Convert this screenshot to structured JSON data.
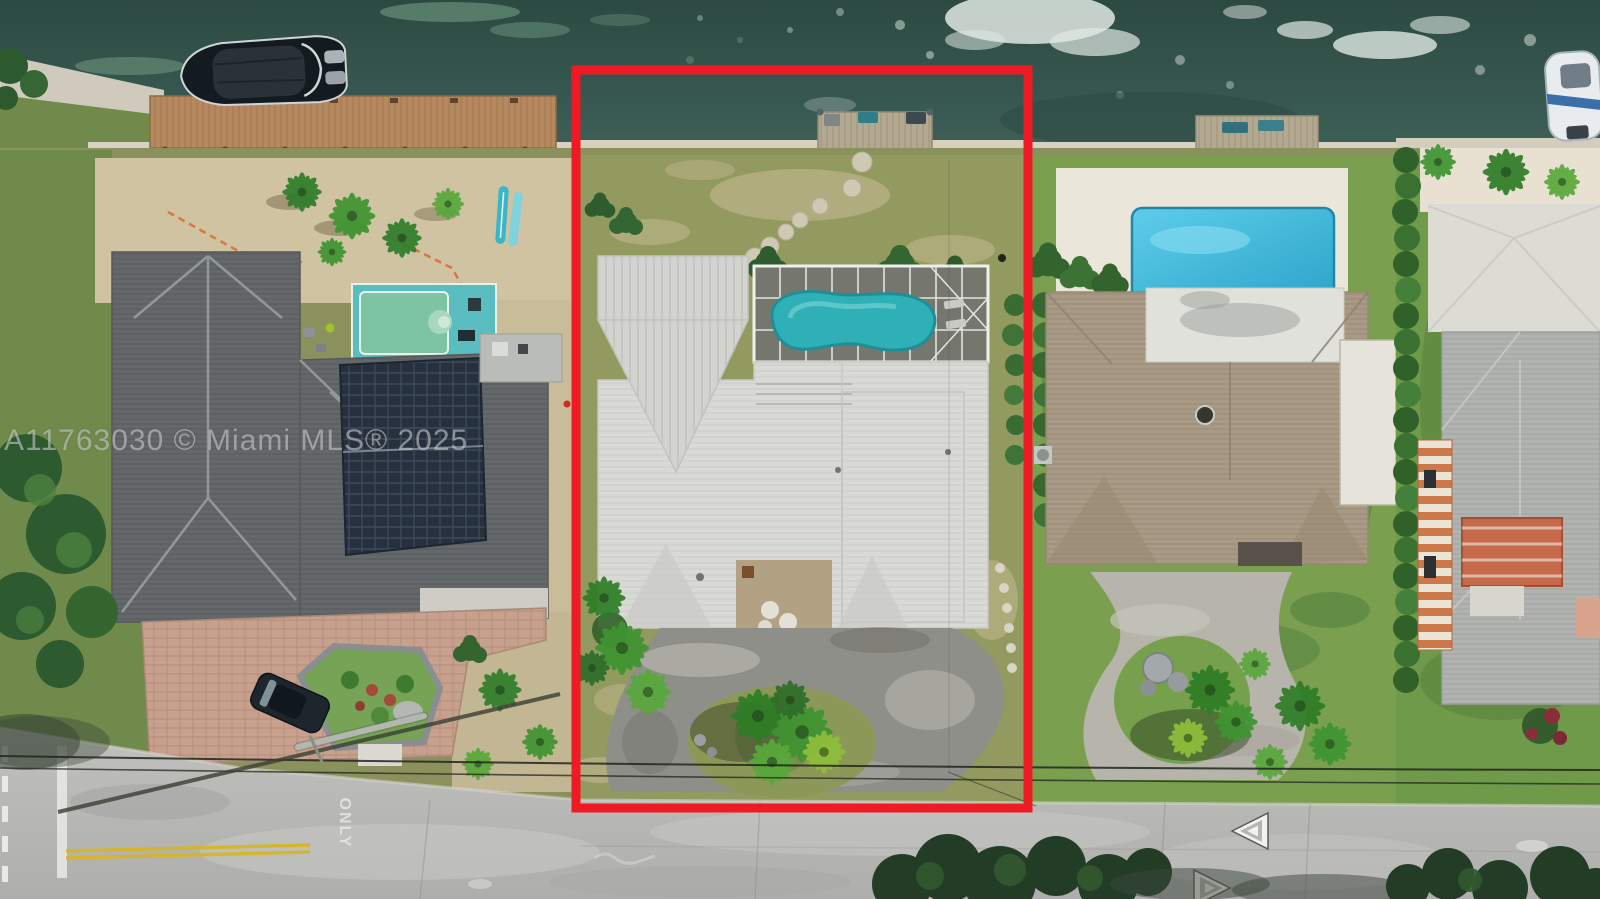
{
  "photo": {
    "type": "aerial drone photo",
    "scene": "waterfront single-family lots on a canal with docks, pools, palms and a street in the foreground",
    "highlighted_lot": "center lot outlined in red"
  },
  "watermark": {
    "text": "A11763030 © Miami MLS® 2025",
    "color": "#D6D6D6"
  },
  "outline": {
    "color": "#EE1B24",
    "shape": "rectangle"
  },
  "road": {
    "only_marking": "ONLY",
    "arrows": [
      "chevron-left",
      "chevron-right"
    ],
    "edge_marking_color": "#FFFFFF",
    "center_line_color": "#D8B623"
  },
  "palette": {
    "water": "#33524A",
    "grass": "#8A9257",
    "sand": "#D0C3A2",
    "road": "#B7B7B5",
    "roof_center_house": "#DADBD7",
    "roof_left_house": "#64686B",
    "roof_right_house": "#A89A85",
    "pool_center": "#2FB0B6",
    "pool_right": "#44BEE0",
    "pool_under_construction": "#7CC4A2",
    "dock_wood": "#B5895F"
  }
}
